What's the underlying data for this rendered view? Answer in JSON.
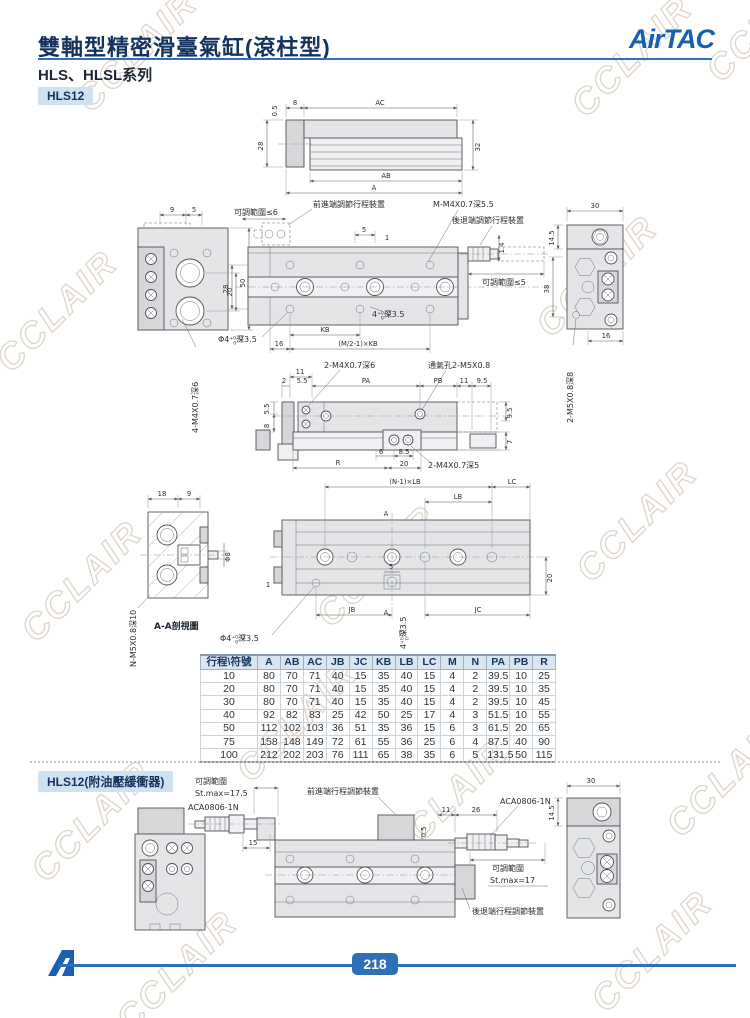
{
  "watermark": {
    "text": "CCLAIR"
  },
  "header": {
    "title": "雙軸型精密滑臺氣缸(滾柱型)",
    "series": "HLS、HLSL系列",
    "logo": "AirTAC",
    "accent_color": "#2e6fb7",
    "logo_color": "#1660b4",
    "tag_bg_color": "#cfe2f2"
  },
  "tags": {
    "model": "HLS12",
    "model_buffer": "HLS12(附油壓緩衝器)"
  },
  "fig1": {
    "dims": {
      "d05": "0.5",
      "d8": "8",
      "ac": "AC",
      "d28": "28",
      "d32": "32",
      "ab": "AB",
      "a": "A"
    }
  },
  "fig2": {
    "labels": {
      "adj6": "可調範圍≤6",
      "front_dev": "前進端調節行程裝置",
      "m_thread": "M-M4X0.7深5.5",
      "rear_dev": "後退端調節行程裝置",
      "adj5": "可調範圍≤5",
      "corner_thread": "4-M4X0.7深6",
      "side_thread": "2-M5X0.8深8"
    },
    "dims": {
      "d9": "9",
      "d5l": "5",
      "d20": "20",
      "d50": "50",
      "d5": "5",
      "d1": "1",
      "d28": "28",
      "d14": "1.4",
      "kb": "KB",
      "d16": "16",
      "mkb": "(M/2-1)×KB",
      "d30": "30",
      "d145": "14.5",
      "d38": "38",
      "d16r": "16"
    },
    "tol1": {
      "pre": "Φ4",
      "sup": "+0.03",
      "sub": "0",
      "post": "深3.5"
    },
    "tol2": {
      "pre": "4",
      "sup": "+0.03",
      "sub": "0",
      "post": "深3.5"
    }
  },
  "fig3": {
    "labels": {
      "top_thread": "2-M4X0.7深6",
      "vent": "通氣孔2-M5X0.8",
      "bottom_thread": "2-M4X0.7深5"
    },
    "dims": {
      "d11": "11",
      "d2": "2",
      "d55a": "5.5",
      "pa": "PA",
      "pb": "PB",
      "d11r": "11",
      "d95t": "9.5",
      "d55l": "5.5",
      "d8": "8",
      "d95r": "9.5",
      "d7": "7",
      "d6": "6",
      "d85": "8.5",
      "r": "R",
      "d20": "20"
    }
  },
  "fig4": {
    "labels": {
      "section": "A-A剖視圖",
      "n_thread": "N-M5X0.8深10"
    },
    "dims": {
      "d18": "18",
      "d9": "9",
      "phi8": "Φ8",
      "nlb": "(N-1)×LB",
      "lc": "LC",
      "lb": "LB",
      "a_top": "A",
      "d1": "1",
      "d5": "5",
      "d20": "20",
      "jb": "JB",
      "a_bot": "A",
      "jc": "JC"
    },
    "tol1": {
      "pre": "Φ4",
      "sup": "+0.03",
      "sub": "0",
      "post": "深3.5"
    },
    "tol2": {
      "pre": "4",
      "sup": "+0.03",
      "sub": "0",
      "post": "深3.5"
    }
  },
  "table": {
    "headers": [
      "行程\\符號",
      "A",
      "AB",
      "AC",
      "JB",
      "JC",
      "KB",
      "LB",
      "LC",
      "M",
      "N",
      "PA",
      "PB",
      "R"
    ],
    "rows": [
      [
        "10",
        "80",
        "70",
        "71",
        "40",
        "15",
        "35",
        "40",
        "15",
        "4",
        "2",
        "39.5",
        "10",
        "25"
      ],
      [
        "20",
        "80",
        "70",
        "71",
        "40",
        "15",
        "35",
        "40",
        "15",
        "4",
        "2",
        "39.5",
        "10",
        "35"
      ],
      [
        "30",
        "80",
        "70",
        "71",
        "40",
        "15",
        "35",
        "40",
        "15",
        "4",
        "2",
        "39.5",
        "10",
        "45"
      ],
      [
        "40",
        "92",
        "82",
        "83",
        "25",
        "42",
        "50",
        "25",
        "17",
        "4",
        "3",
        "51.5",
        "10",
        "55"
      ],
      [
        "50",
        "112",
        "102",
        "103",
        "36",
        "51",
        "35",
        "36",
        "15",
        "6",
        "3",
        "61.5",
        "20",
        "65"
      ],
      [
        "75",
        "158",
        "148",
        "149",
        "72",
        "61",
        "55",
        "36",
        "25",
        "6",
        "4",
        "87.5",
        "40",
        "90"
      ],
      [
        "100",
        "212",
        "202",
        "203",
        "76",
        "111",
        "65",
        "38",
        "35",
        "6",
        "5",
        "131.5",
        "50",
        "115"
      ]
    ]
  },
  "fig5": {
    "labels": {
      "adj_range_l": "可調範圍",
      "stmax_l": "St.max=17.5",
      "buffer_l": "ACA0806-1N",
      "front_dev": "前進端行程調節裝置",
      "buffer_r": "ACA0806-1N",
      "adj_range_r": "可調範圍",
      "stmax_r": "St.max=17",
      "rear_dev": "後退端行程調節裝置"
    },
    "dims": {
      "d15": "15",
      "d05": "0.5",
      "d11": "11",
      "d26": "26",
      "d30": "30",
      "d145": "14.5"
    }
  },
  "footer": {
    "page": "218"
  }
}
